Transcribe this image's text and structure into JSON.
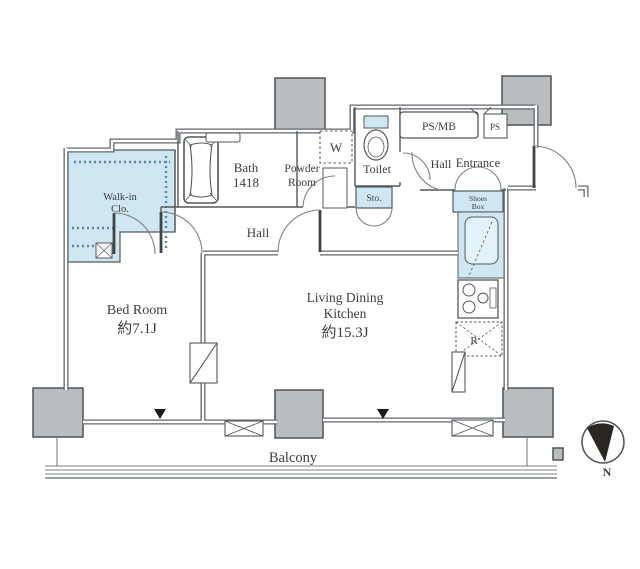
{
  "plan": {
    "title": "apartment-floor-plan",
    "rooms": {
      "walk_in_closet": {
        "line1": "Walk-in",
        "line2": "Clo."
      },
      "bath": {
        "line1": "Bath",
        "line2": "1418"
      },
      "powder_room": {
        "line1": "Powder",
        "line2": "Room"
      },
      "washer": {
        "label": "W"
      },
      "toilet": {
        "label": "Toilet"
      },
      "hall_upper": {
        "label": "Hall"
      },
      "ps_mb": {
        "label": "PS/MB"
      },
      "ps": {
        "label": "PS"
      },
      "entrance": {
        "label": "Entrance"
      },
      "shoes_box": {
        "line1": "Shoes",
        "line2": "Box"
      },
      "storage": {
        "label": "Sto."
      },
      "hall_center": {
        "label": "Hall"
      },
      "bedroom": {
        "name": "Bed Room",
        "size": "約7.1J"
      },
      "ldk": {
        "line1": "Living Dining",
        "line2": "Kitchen",
        "size": "約15.3J"
      },
      "refrigerator": {
        "label": "R"
      },
      "balcony": {
        "label": "Balcony"
      }
    },
    "compass": {
      "label": "N"
    },
    "colors": {
      "fixture_blue": "#cfe7f2",
      "sink_blue": "#e3f1f8",
      "pillar_gray": "#b9bdc0",
      "wall_dark": "#60666a",
      "line": "#54595c",
      "text": "#3a3f42"
    }
  }
}
